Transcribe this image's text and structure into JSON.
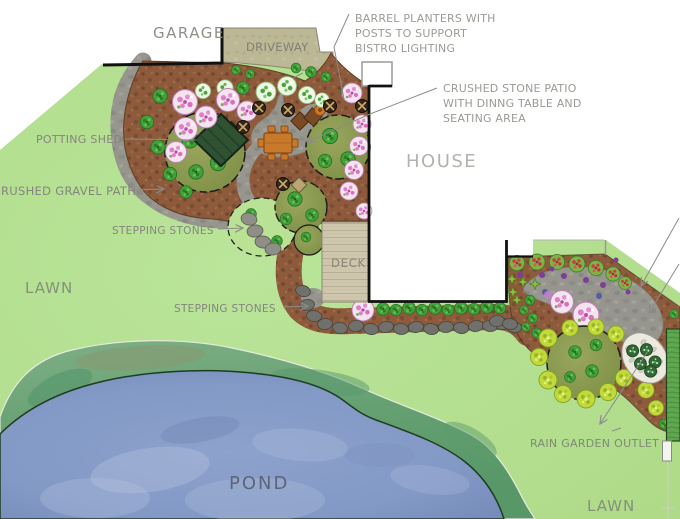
{
  "plan": {
    "labels": {
      "garage": "GARAGE",
      "driveway": "DRIVEWAY",
      "house": "HOUSE",
      "deck": "DECK",
      "lawn_left": "LAWN",
      "lawn_bottom_right": "LAWN",
      "pond": "POND",
      "potting_shed": "POTTING SHED",
      "gravel_path": "RUSHED GRAVEL PATH",
      "stepping_stones_upper": "STEPPING STONES",
      "stepping_stones_lower": "STEPPING STONES",
      "rain_garden_outlet": "RAIN GARDEN OUTLET"
    },
    "annotations": {
      "barrel_planters": {
        "lines": [
          "BARREL PLANTERS WITH",
          "POSTS TO SUPPORT",
          "BISTRO LIGHTING"
        ]
      },
      "crushed_stone_patio": {
        "lines": [
          "CRUSHED STONE PATIO",
          "WITH DINNG TABLE AND",
          "SEATING AREA"
        ]
      }
    },
    "features": {
      "planting_bed": "planting-bed",
      "crushed_gravel_path": "crushed-gravel-path",
      "crushed_stone_patio": "crushed-stone-patio",
      "dining_table": "dining-table-with-chairs",
      "barrel_planter": "barrel-planter",
      "potting_shed": "potting-shed",
      "stepping_stones": "stepping-stones",
      "rain_garden": "rain-garden-outlet-basin",
      "pond": "pond",
      "lawn": "lawn",
      "deck": "deck",
      "house": "house",
      "garage": "garage",
      "driveway": "driveway"
    },
    "colors": {
      "lawn": "#b7e193",
      "bed_soil": "#8d5a3c",
      "path_gray": "#96968f",
      "driveway_tan": "#bcb795",
      "deck_wood": "#cfc6ae",
      "pond_water": "#8399c6",
      "pond_edge": "#66a173",
      "tree_canopy": "#8a9a50",
      "shrub_green": "#43a13a",
      "shrub_pink": "#e07fc7",
      "shrub_yellow": "#c3d93b",
      "rain_garden_gravel": "#ece9df",
      "table_wood": "#c87a2a",
      "label_gray": "#85857e",
      "outline_black": "#1a1a1a"
    }
  }
}
